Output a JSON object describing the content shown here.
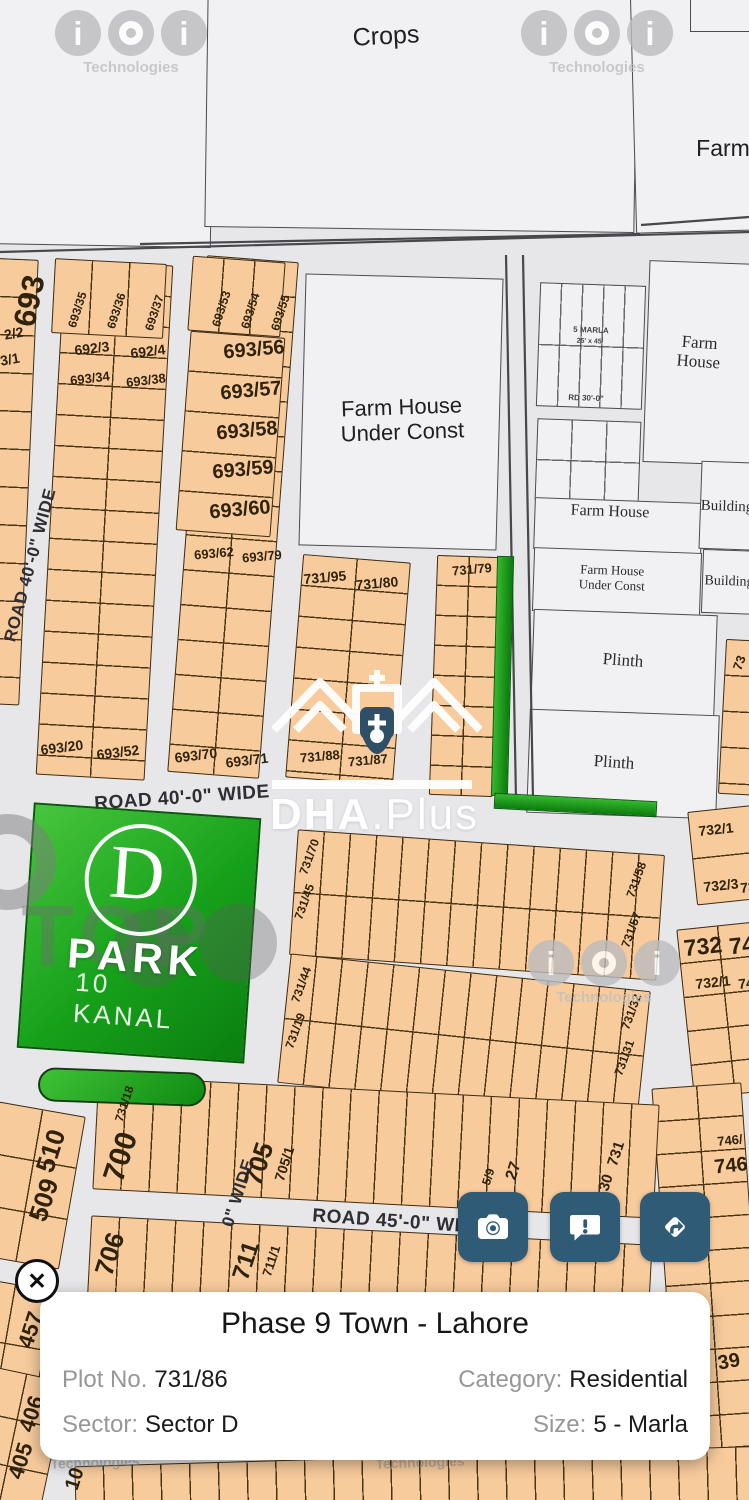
{
  "card": {
    "title": "Phase 9 Town - Lahore",
    "plot_no_label": "Plot No.",
    "plot_no": "731/86",
    "category_label": "Category:",
    "category": "Residential",
    "sector_label": "Sector:",
    "sector": "Sector D",
    "size_label": "Size:",
    "size": "5 - Marla",
    "close_glyph": "✕"
  },
  "buttons": {
    "icons": [
      "camera-icon",
      "comment-exclamation-icon",
      "directions-icon"
    ],
    "color": "#305b76"
  },
  "map": {
    "colors": {
      "road_bg": "#e7e7ea",
      "parcel": "#f1f1f3",
      "plot_fill": "#f7cb9c",
      "plot_border": "#3e2c12",
      "park_green": "#16a01a",
      "button_teal": "#305b76"
    },
    "watermarks": {
      "brand": "Technologies",
      "ioi": [
        {
          "x": 131,
          "y": 33
        },
        {
          "x": 597,
          "y": 33
        },
        {
          "x": 604,
          "y": 963
        }
      ],
      "top": {
        "text": "TOP",
        "tx": 118,
        "ty": 937,
        "tf": 86,
        "ring": {
          "x": 8,
          "y": 862,
          "d": 96,
          "t": 20
        },
        "blobs": [
          [
            152,
            948,
            78
          ],
          [
            238,
            943,
            78
          ]
        ]
      },
      "dha": {
        "bold": "DHA",
        "rest": ".Plus"
      },
      "faint": [
        {
          "x": 95,
          "y": 1463
        },
        {
          "x": 420,
          "y": 1463
        }
      ]
    },
    "greens": {
      "park": {
        "x": 25,
        "y": 810,
        "w": 228,
        "h": 246,
        "r": 4,
        "letter": "D",
        "name": "PARK",
        "size_label": "10 KANAL"
      },
      "strip_v": {
        "x": 494,
        "y": 556,
        "w": 17,
        "h": 240,
        "r": 1.5
      },
      "bar_h": {
        "x": 494,
        "y": 797,
        "w": 163,
        "h": 16,
        "r": 3
      },
      "pill": {
        "x": 38,
        "y": 1070,
        "w": 168,
        "h": 34,
        "r": 2
      }
    },
    "parcels": [
      [
        -12,
        -10,
        225,
        256,
        1,
        1,
        0,
        "top-left"
      ],
      [
        206,
        -8,
        430,
        238,
        0.8,
        1,
        0,
        "crops"
      ],
      [
        633,
        -8,
        126,
        240,
        -1.5,
        1,
        0,
        "top-right"
      ],
      [
        690,
        -6,
        76,
        38,
        0,
        1,
        0,
        "top-right-box"
      ],
      [
        302,
        276,
        198,
        272,
        1.5,
        1,
        0,
        "farm-house-under-const"
      ],
      [
        538,
        284,
        106,
        124,
        2,
        5,
        62,
        "marla-grid"
      ],
      [
        646,
        262,
        110,
        202,
        2,
        1,
        0,
        "farm-house-right"
      ],
      [
        536,
        420,
        104,
        82,
        2,
        3,
        41,
        "grid-2"
      ],
      [
        534,
        500,
        168,
        52,
        2,
        1,
        0,
        "farm-house-mid"
      ],
      [
        533,
        550,
        168,
        64,
        2,
        1,
        0,
        "farm-house-uc-2"
      ],
      [
        700,
        462,
        72,
        88,
        2,
        1,
        0,
        "building-1"
      ],
      [
        702,
        550,
        62,
        64,
        2,
        1,
        0,
        "building-2"
      ],
      [
        532,
        612,
        184,
        102,
        2,
        1,
        0,
        "plinth-1"
      ],
      [
        528,
        712,
        190,
        104,
        2,
        1,
        0,
        "plinth-2"
      ]
    ],
    "lines": [
      [
        0,
        252,
        749,
        232
      ],
      [
        140,
        244,
        640,
        234
      ],
      [
        506,
        255,
        516,
        800
      ],
      [
        523,
        255,
        533,
        800
      ],
      [
        641,
        225,
        749,
        217
      ]
    ],
    "blocks": [
      [
        -46,
        258,
        75,
        446,
        2.5,
        1,
        38,
        "693-left"
      ],
      [
        50,
        262,
        109,
        516,
        3.2,
        2,
        31,
        "693-b"
      ],
      [
        53,
        261,
        112,
        75,
        3,
        3,
        0,
        "693-b-top"
      ],
      [
        187,
        258,
        92,
        518,
        4.4,
        2,
        35,
        "693-c"
      ],
      [
        183,
        334,
        95,
        200,
        4.3,
        1,
        40,
        "693-c-mid"
      ],
      [
        190,
        259,
        93,
        75,
        4.2,
        3,
        0,
        "693-c-top"
      ],
      [
        294,
        558,
        108,
        224,
        4.6,
        2,
        31,
        "731-d"
      ],
      [
        433,
        556,
        64,
        240,
        2,
        2,
        30,
        "731-e"
      ],
      [
        722,
        640,
        45,
        155,
        3,
        1,
        36,
        "73-partial"
      ],
      [
        692,
        808,
        70,
        94,
        -6,
        1,
        47,
        "732-a"
      ],
      [
        685,
        925,
        82,
        170,
        -6,
        2,
        34,
        "732-b"
      ],
      [
        666,
        1085,
        90,
        420,
        -4,
        2,
        33,
        "746-col"
      ],
      [
        293,
        842,
        368,
        126,
        4,
        14,
        63,
        "slab-731-upper"
      ],
      [
        283,
        972,
        362,
        130,
        6,
        14,
        65,
        "slab-731-lower"
      ],
      [
        95,
        1090,
        562,
        114,
        3,
        20,
        0,
        "slab-700-705"
      ],
      [
        88,
        1230,
        562,
        112,
        3,
        20,
        0,
        "slab-706-711"
      ],
      [
        -15,
        1108,
        88,
        155,
        10,
        2,
        52,
        "509-510"
      ],
      [
        -35,
        1283,
        80,
        120,
        10,
        2,
        60,
        "457"
      ],
      [
        -30,
        1372,
        84,
        140,
        12,
        2,
        47,
        "405-406"
      ],
      [
        75,
        1456,
        690,
        60,
        -1.7,
        24,
        0,
        "bottom-row"
      ]
    ],
    "labels": [
      [
        "Crops",
        386,
        36,
        25,
        -3,
        "sans"
      ],
      [
        "Farm",
        723,
        149,
        23,
        0,
        "sans"
      ],
      [
        "Farm House\nUnder Const",
        402,
        420,
        22,
        -2,
        "sans"
      ],
      [
        "5 MARLA",
        591,
        331,
        8,
        2,
        "tiny"
      ],
      [
        "25' x 45'",
        590,
        342,
        7,
        2,
        "tiny"
      ],
      [
        "RD 30'-0\"",
        586,
        399,
        8,
        2,
        "tiny"
      ],
      [
        "Farm House",
        699,
        352,
        17,
        4,
        "serif"
      ],
      [
        "Farm House",
        610,
        512,
        16,
        2,
        "serif"
      ],
      [
        "Farm House\nUnder Const",
        612,
        578,
        13,
        2,
        "serif"
      ],
      [
        "Building",
        727,
        507,
        15,
        2,
        "serif"
      ],
      [
        "Building",
        729,
        582,
        14,
        2,
        "serif"
      ],
      [
        "Plinth",
        623,
        660,
        17,
        4,
        "serif"
      ],
      [
        "Plinth",
        614,
        762,
        17,
        4,
        "serif"
      ],
      [
        "ROAD 40'-0\" WIDE",
        30,
        565,
        17,
        -75,
        "road"
      ],
      [
        "ROAD 40'-0\" WIDE",
        182,
        798,
        19,
        -4,
        "road"
      ],
      [
        "ROAD 45'-0\" WIDE",
        400,
        1222,
        19,
        4,
        "road"
      ],
      [
        "0\" WIDE",
        238,
        1193,
        17,
        -72,
        "road"
      ],
      [
        "693",
        30,
        301,
        31,
        -78,
        "plot"
      ],
      [
        "2/2",
        14,
        334,
        14,
        -10,
        "plot"
      ],
      [
        "3/1",
        10,
        360,
        14,
        -10,
        "plot"
      ],
      [
        "693/35",
        78,
        310,
        12,
        -72,
        "plot"
      ],
      [
        "693/36",
        117,
        311,
        12,
        -72,
        "plot"
      ],
      [
        "693/37",
        155,
        313,
        12,
        -72,
        "plot"
      ],
      [
        "692/3",
        92,
        349,
        14,
        -7,
        "plot"
      ],
      [
        "692/4",
        148,
        352,
        14,
        -7,
        "plot"
      ],
      [
        "693/34",
        90,
        379,
        13,
        -7,
        "plot"
      ],
      [
        "693/38",
        146,
        381,
        13,
        -7,
        "plot"
      ],
      [
        "693/20",
        62,
        748,
        14,
        -7,
        "plot"
      ],
      [
        "693/52",
        118,
        753,
        14,
        -7,
        "plot"
      ],
      [
        "693/53",
        222,
        309,
        12,
        -72,
        "plot"
      ],
      [
        "693/54",
        251,
        311,
        12,
        -72,
        "plot"
      ],
      [
        "693/55",
        281,
        313,
        12,
        -72,
        "plot"
      ],
      [
        "693/56",
        254,
        350,
        20,
        -5,
        "plot"
      ],
      [
        "693/57",
        251,
        391,
        20,
        -5,
        "plot"
      ],
      [
        "693/58",
        247,
        431,
        20,
        -5,
        "plot"
      ],
      [
        "693/59",
        243,
        470,
        20,
        -5,
        "plot"
      ],
      [
        "693/60",
        240,
        510,
        20,
        -5,
        "plot"
      ],
      [
        "693/62",
        214,
        554,
        13,
        -5,
        "plot"
      ],
      [
        "693/79",
        262,
        557,
        13,
        -5,
        "plot"
      ],
      [
        "693/70",
        196,
        756,
        14,
        -7,
        "plot"
      ],
      [
        "693/71",
        247,
        761,
        14,
        -7,
        "plot"
      ],
      [
        "731/95",
        325,
        578,
        14,
        -5,
        "plot"
      ],
      [
        "731/80",
        377,
        584,
        14,
        -5,
        "plot"
      ],
      [
        "731/88",
        320,
        757,
        13,
        -5,
        "plot"
      ],
      [
        "731/87",
        368,
        761,
        13,
        -5,
        "plot"
      ],
      [
        "731/79",
        472,
        570,
        13,
        -5,
        "plot"
      ],
      [
        "73",
        740,
        663,
        13,
        -70,
        "plot"
      ],
      [
        "731/70",
        310,
        857,
        12,
        -70,
        "plot"
      ],
      [
        "731/45",
        305,
        902,
        12,
        -70,
        "plot"
      ],
      [
        "731/58",
        637,
        880,
        12,
        -70,
        "plot"
      ],
      [
        "731/57",
        632,
        930,
        12,
        -70,
        "plot"
      ],
      [
        "731/44",
        302,
        985,
        12,
        -70,
        "plot"
      ],
      [
        "731/19",
        296,
        1031,
        12,
        -70,
        "plot"
      ],
      [
        "731/32",
        632,
        1012,
        12,
        -70,
        "plot"
      ],
      [
        "731/31",
        625,
        1058,
        12,
        -70,
        "plot"
      ],
      [
        "732/1",
        716,
        830,
        14,
        -6,
        "plot"
      ],
      [
        "732/3",
        721,
        886,
        14,
        -6,
        "plot"
      ],
      [
        "73",
        748,
        888,
        14,
        -6,
        "plot"
      ],
      [
        "732",
        703,
        947,
        23,
        -6,
        "plot"
      ],
      [
        "74",
        742,
        946,
        23,
        -6,
        "plot"
      ],
      [
        "732/1",
        713,
        983,
        14,
        -6,
        "plot"
      ],
      [
        "74",
        746,
        984,
        14,
        -6,
        "plot"
      ],
      [
        "731/18",
        125,
        1104,
        12,
        -72,
        "plot"
      ],
      [
        "700",
        121,
        1157,
        30,
        -72,
        "plot"
      ],
      [
        "705",
        259,
        1164,
        26,
        -72,
        "plot"
      ],
      [
        "705/1",
        285,
        1164,
        14,
        -72,
        "plot"
      ],
      [
        "5/9",
        489,
        1177,
        12,
        -72,
        "plot"
      ],
      [
        "27",
        514,
        1171,
        16,
        -72,
        "plot"
      ],
      [
        "731",
        617,
        1154,
        15,
        -72,
        "plot"
      ],
      [
        "30",
        607,
        1183,
        15,
        -72,
        "plot"
      ],
      [
        "706",
        110,
        1254,
        26,
        -72,
        "plot"
      ],
      [
        "711",
        247,
        1261,
        24,
        -72,
        "plot"
      ],
      [
        "711/1",
        272,
        1261,
        13,
        -72,
        "plot"
      ],
      [
        "510",
        51,
        1151,
        26,
        -72,
        "plot"
      ],
      [
        "509",
        44,
        1200,
        26,
        -72,
        "plot"
      ],
      [
        "457",
        31,
        1330,
        22,
        -72,
        "plot"
      ],
      [
        "406",
        32,
        1414,
        22,
        -72,
        "plot"
      ],
      [
        "405",
        21,
        1461,
        22,
        -72,
        "plot"
      ],
      [
        "10",
        75,
        1479,
        20,
        -72,
        "plot"
      ],
      [
        "746/",
        730,
        1141,
        13,
        -6,
        "plot"
      ],
      [
        "746",
        731,
        1166,
        20,
        -6,
        "plot"
      ],
      [
        "39",
        729,
        1362,
        20,
        -10,
        "plot"
      ],
      [
        "Technologies",
        95,
        1463,
        14,
        -2,
        "wmfaint"
      ],
      [
        "Technologies",
        420,
        1463,
        14,
        -2,
        "wmfaint"
      ]
    ]
  }
}
